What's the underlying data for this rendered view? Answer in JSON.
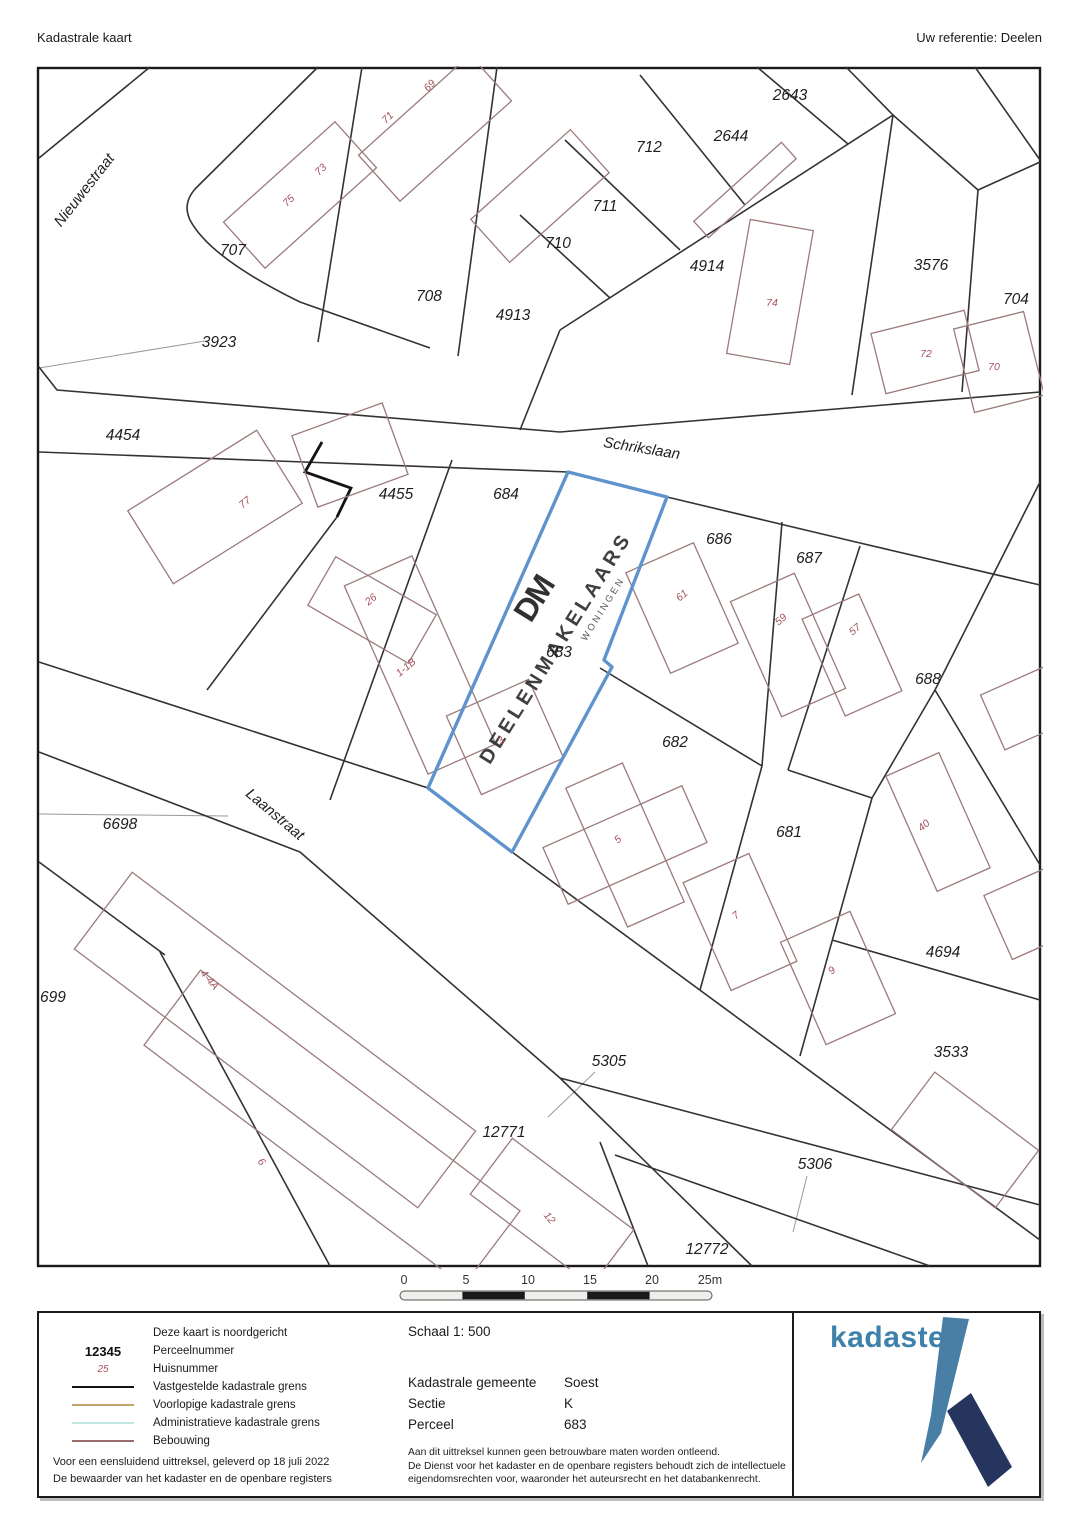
{
  "header": {
    "title": "Kadastrale kaart",
    "reference": "Uw referentie: Deelen"
  },
  "map": {
    "street_names": [
      "Nieuwestraat",
      "Schrikslaan",
      "Laanstraat"
    ],
    "parcel_labels": [
      "2643",
      "2644",
      "712",
      "711",
      "710",
      "707",
      "708",
      "4913",
      "4914",
      "3576",
      "704",
      "3923",
      "4454",
      "4455",
      "684",
      "686",
      "687",
      "688",
      "683",
      "682",
      "681",
      "4694",
      "3533",
      "6698",
      "699",
      "5305",
      "12771",
      "5306",
      "12772"
    ],
    "house_numbers": [
      "69",
      "71",
      "73",
      "75",
      "74",
      "72",
      "70",
      "77",
      "26",
      "1-1B",
      "3",
      "61",
      "59",
      "57",
      "5",
      "7",
      "9",
      "40",
      "4-4A",
      "6",
      "12"
    ],
    "highlighted_parcel": "683",
    "watermark": {
      "monogram": "DM",
      "name": "DEELENMAKELAARS",
      "subtitle": "WONINGEN"
    },
    "colors": {
      "boundary": "#333333",
      "building": "#9b7b7b",
      "house_number": "#a3505c",
      "highlight": "#5f93ce"
    }
  },
  "scale_bar": {
    "ticks": [
      "0",
      "5",
      "10",
      "15",
      "20",
      "25m"
    ]
  },
  "legend": {
    "rows": [
      {
        "sample": "",
        "label": "Deze kaart is noordgericht"
      },
      {
        "sample": "12345",
        "label": "Perceelnummer"
      },
      {
        "sample": "25",
        "label": "Huisnummer"
      },
      {
        "sample": "line-black",
        "label": "Vastgestelde kadastrale grens"
      },
      {
        "sample": "line-tan",
        "label": "Voorlopige kadastrale grens"
      },
      {
        "sample": "line-cyan",
        "label": "Administratieve kadastrale grens"
      },
      {
        "sample": "line-maroon",
        "label": "Bebouwing"
      }
    ],
    "footer_line1": "Voor een eensluidend uittreksel, geleverd op 18 juli 2022",
    "footer_line2": "De bewaarder van het kadaster en de openbare registers"
  },
  "info": {
    "scale": "Schaal 1: 500",
    "fields": [
      {
        "key": "Kadastrale gemeente",
        "value": "Soest"
      },
      {
        "key": "Sectie",
        "value": "K"
      },
      {
        "key": "Perceel",
        "value": "683"
      }
    ],
    "disclaimer_line1": "Aan dit uittreksel kunnen geen betrouwbare maten worden ontleend.",
    "disclaimer_line2": "De Dienst voor het kadaster en de openbare registers behoudt zich de intellectuele",
    "disclaimer_line3": "eigendomsrechten voor, waaronder het auteursrecht en het databankenrecht."
  },
  "logo": {
    "wordmark": "kadaster"
  }
}
